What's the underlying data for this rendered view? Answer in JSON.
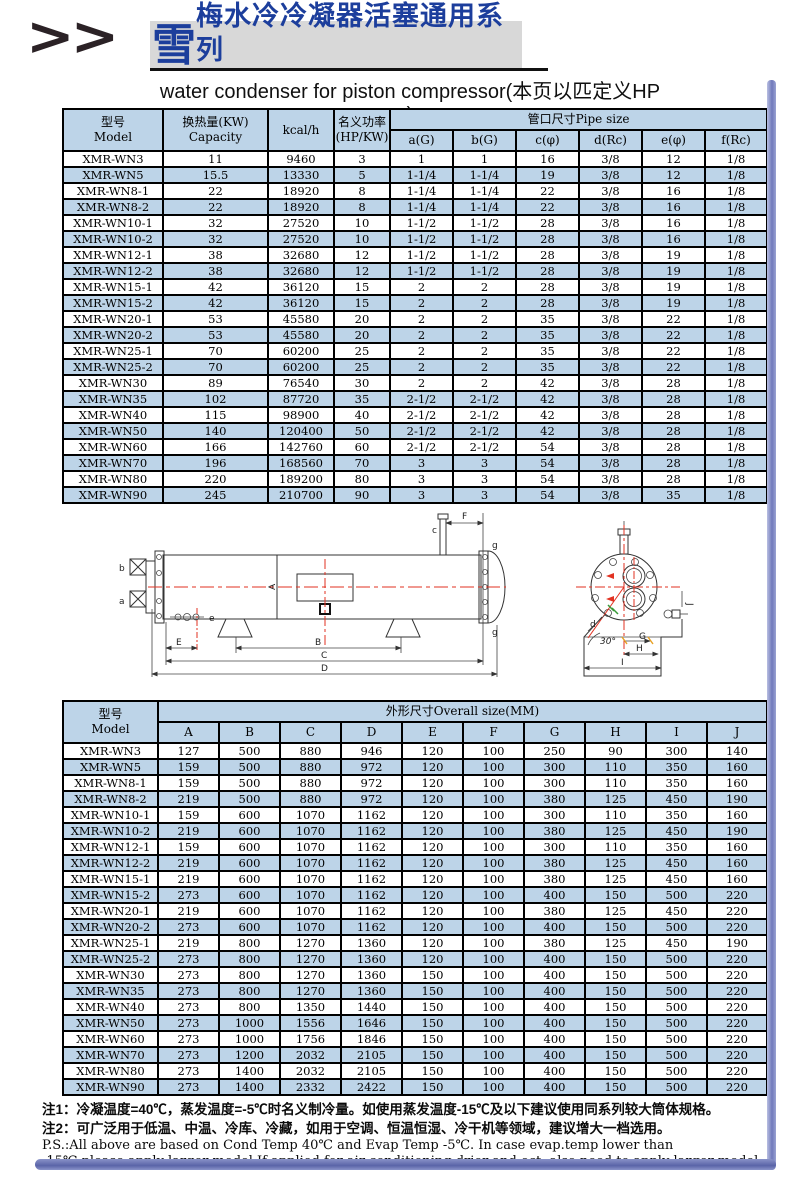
{
  "header": {
    "chevrons": ">>",
    "logo_char": "雪",
    "title_cn": "梅水冷冷凝器活塞通用系列",
    "subtitle": "water condenser for piston compressor(本页以匹定义HP )"
  },
  "colors": {
    "table_header_bg": "#bdd4e8",
    "row_alt_bg": "#bdd4e8",
    "title_blue": "#1c3e9c",
    "title_box_gray": "#d8d8d8",
    "centerline_red": "#e23222",
    "edge_bar_blue": "#7079bb"
  },
  "table1": {
    "header": {
      "model_cn": "型号",
      "model_en": "Model",
      "capacity_cn": "换热量(KW)",
      "capacity_en": "Capacity",
      "kcal": "kcal/h",
      "power_cn": "名义功率",
      "power_en": "(HP/KW)",
      "pipe_group": "管口尺寸Pipe size",
      "pipe_cols": [
        "a(G)",
        "b(G)",
        "c(φ)",
        "d(Rc)",
        "e(φ)",
        "f(Rc)"
      ]
    },
    "rows": [
      [
        "XMR-WN3",
        "11",
        "9460",
        "3",
        "1",
        "1",
        "16",
        "3/8",
        "12",
        "1/8"
      ],
      [
        "XMR-WN5",
        "15.5",
        "13330",
        "5",
        "1-1/4",
        "1-1/4",
        "19",
        "3/8",
        "12",
        "1/8"
      ],
      [
        "XMR-WN8-1",
        "22",
        "18920",
        "8",
        "1-1/4",
        "1-1/4",
        "22",
        "3/8",
        "16",
        "1/8"
      ],
      [
        "XMR-WN8-2",
        "22",
        "18920",
        "8",
        "1-1/4",
        "1-1/4",
        "22",
        "3/8",
        "16",
        "1/8"
      ],
      [
        "XMR-WN10-1",
        "32",
        "27520",
        "10",
        "1-1/2",
        "1-1/2",
        "28",
        "3/8",
        "16",
        "1/8"
      ],
      [
        "XMR-WN10-2",
        "32",
        "27520",
        "10",
        "1-1/2",
        "1-1/2",
        "28",
        "3/8",
        "16",
        "1/8"
      ],
      [
        "XMR-WN12-1",
        "38",
        "32680",
        "12",
        "1-1/2",
        "1-1/2",
        "28",
        "3/8",
        "19",
        "1/8"
      ],
      [
        "XMR-WN12-2",
        "38",
        "32680",
        "12",
        "1-1/2",
        "1-1/2",
        "28",
        "3/8",
        "19",
        "1/8"
      ],
      [
        "XMR-WN15-1",
        "42",
        "36120",
        "15",
        "2",
        "2",
        "28",
        "3/8",
        "19",
        "1/8"
      ],
      [
        "XMR-WN15-2",
        "42",
        "36120",
        "15",
        "2",
        "2",
        "28",
        "3/8",
        "19",
        "1/8"
      ],
      [
        "XMR-WN20-1",
        "53",
        "45580",
        "20",
        "2",
        "2",
        "35",
        "3/8",
        "22",
        "1/8"
      ],
      [
        "XMR-WN20-2",
        "53",
        "45580",
        "20",
        "2",
        "2",
        "35",
        "3/8",
        "22",
        "1/8"
      ],
      [
        "XMR-WN25-1",
        "70",
        "60200",
        "25",
        "2",
        "2",
        "35",
        "3/8",
        "22",
        "1/8"
      ],
      [
        "XMR-WN25-2",
        "70",
        "60200",
        "25",
        "2",
        "2",
        "35",
        "3/8",
        "22",
        "1/8"
      ],
      [
        "XMR-WN30",
        "89",
        "76540",
        "30",
        "2",
        "2",
        "42",
        "3/8",
        "28",
        "1/8"
      ],
      [
        "XMR-WN35",
        "102",
        "87720",
        "35",
        "2-1/2",
        "2-1/2",
        "42",
        "3/8",
        "28",
        "1/8"
      ],
      [
        "XMR-WN40",
        "115",
        "98900",
        "40",
        "2-1/2",
        "2-1/2",
        "42",
        "3/8",
        "28",
        "1/8"
      ],
      [
        "XMR-WN50",
        "140",
        "120400",
        "50",
        "2-1/2",
        "2-1/2",
        "42",
        "3/8",
        "28",
        "1/8"
      ],
      [
        "XMR-WN60",
        "166",
        "142760",
        "60",
        "2-1/2",
        "2-1/2",
        "54",
        "3/8",
        "28",
        "1/8"
      ],
      [
        "XMR-WN70",
        "196",
        "168560",
        "70",
        "3",
        "3",
        "54",
        "3/8",
        "28",
        "1/8"
      ],
      [
        "XMR-WN80",
        "220",
        "189200",
        "80",
        "3",
        "3",
        "54",
        "3/8",
        "28",
        "1/8"
      ],
      [
        "XMR-WN90",
        "245",
        "210700",
        "90",
        "3",
        "3",
        "54",
        "3/8",
        "35",
        "1/8"
      ]
    ]
  },
  "table2": {
    "header": {
      "model_cn": "型号",
      "model_en": "Model",
      "group": "外形尺寸Overall size(MM)",
      "cols": [
        "A",
        "B",
        "C",
        "D",
        "E",
        "F",
        "G",
        "H",
        "I",
        "J"
      ]
    },
    "rows": [
      [
        "XMR-WN3",
        "127",
        "500",
        "880",
        "946",
        "120",
        "100",
        "250",
        "90",
        "300",
        "140"
      ],
      [
        "XMR-WN5",
        "159",
        "500",
        "880",
        "972",
        "120",
        "100",
        "300",
        "110",
        "350",
        "160"
      ],
      [
        "XMR-WN8-1",
        "159",
        "500",
        "880",
        "972",
        "120",
        "100",
        "300",
        "110",
        "350",
        "160"
      ],
      [
        "XMR-WN8-2",
        "219",
        "500",
        "880",
        "972",
        "120",
        "100",
        "380",
        "125",
        "450",
        "190"
      ],
      [
        "XMR-WN10-1",
        "159",
        "600",
        "1070",
        "1162",
        "120",
        "100",
        "300",
        "110",
        "350",
        "160"
      ],
      [
        "XMR-WN10-2",
        "219",
        "600",
        "1070",
        "1162",
        "120",
        "100",
        "380",
        "125",
        "450",
        "190"
      ],
      [
        "XMR-WN12-1",
        "159",
        "600",
        "1070",
        "1162",
        "120",
        "100",
        "300",
        "110",
        "350",
        "160"
      ],
      [
        "XMR-WN12-2",
        "219",
        "600",
        "1070",
        "1162",
        "120",
        "100",
        "380",
        "125",
        "450",
        "160"
      ],
      [
        "XMR-WN15-1",
        "219",
        "600",
        "1070",
        "1162",
        "120",
        "100",
        "380",
        "125",
        "450",
        "160"
      ],
      [
        "XMR-WN15-2",
        "273",
        "600",
        "1070",
        "1162",
        "120",
        "100",
        "400",
        "150",
        "500",
        "220"
      ],
      [
        "XMR-WN20-1",
        "219",
        "600",
        "1070",
        "1162",
        "120",
        "100",
        "380",
        "125",
        "450",
        "220"
      ],
      [
        "XMR-WN20-2",
        "273",
        "600",
        "1070",
        "1162",
        "120",
        "100",
        "400",
        "150",
        "500",
        "220"
      ],
      [
        "XMR-WN25-1",
        "219",
        "800",
        "1270",
        "1360",
        "120",
        "100",
        "380",
        "125",
        "450",
        "190"
      ],
      [
        "XMR-WN25-2",
        "273",
        "800",
        "1270",
        "1360",
        "120",
        "100",
        "400",
        "150",
        "500",
        "220"
      ],
      [
        "XMR-WN30",
        "273",
        "800",
        "1270",
        "1360",
        "150",
        "100",
        "400",
        "150",
        "500",
        "220"
      ],
      [
        "XMR-WN35",
        "273",
        "800",
        "1270",
        "1360",
        "150",
        "100",
        "400",
        "150",
        "500",
        "220"
      ],
      [
        "XMR-WN40",
        "273",
        "800",
        "1350",
        "1440",
        "150",
        "100",
        "400",
        "150",
        "500",
        "220"
      ],
      [
        "XMR-WN50",
        "273",
        "1000",
        "1556",
        "1646",
        "150",
        "100",
        "400",
        "150",
        "500",
        "220"
      ],
      [
        "XMR-WN60",
        "273",
        "1000",
        "1756",
        "1846",
        "150",
        "100",
        "400",
        "150",
        "500",
        "220"
      ],
      [
        "XMR-WN70",
        "273",
        "1200",
        "2032",
        "2105",
        "150",
        "100",
        "400",
        "150",
        "500",
        "220"
      ],
      [
        "XMR-WN80",
        "273",
        "1400",
        "2032",
        "2105",
        "150",
        "100",
        "400",
        "150",
        "500",
        "220"
      ],
      [
        "XMR-WN90",
        "273",
        "1400",
        "2332",
        "2422",
        "150",
        "100",
        "400",
        "150",
        "500",
        "220"
      ]
    ]
  },
  "diagram": {
    "side": {
      "F": "F",
      "c": "c",
      "g_top": "g",
      "g_bot": "g",
      "b": "b",
      "a": "a",
      "e": "e",
      "A": "A",
      "E": "E",
      "B": "B",
      "C": "C",
      "D": "D"
    },
    "end": {
      "d": "d",
      "angle": "30°",
      "G": "G",
      "H": "H",
      "I": "I",
      "J": "J"
    }
  },
  "notes": {
    "note1": "注1：冷凝温度=40℃，蒸发温度=-5℃时名义制冷量。如使用蒸发温度-15℃及以下建议使用同系列较大筒体规格。",
    "note2": "注2：可广泛用于低温、中温、冷库、冷藏，如用于空调、恒温恒湿、冷干机等领域，建议增大一档选用。",
    "ps1": "P.S.:All above are based on Cond Temp 40℃ and Evap Temp -5℃. In case evap.temp lower than",
    "ps2": "-15℃,please apply larger model.If applied for air conditioning,drier and ect, also need to apply larger model."
  }
}
